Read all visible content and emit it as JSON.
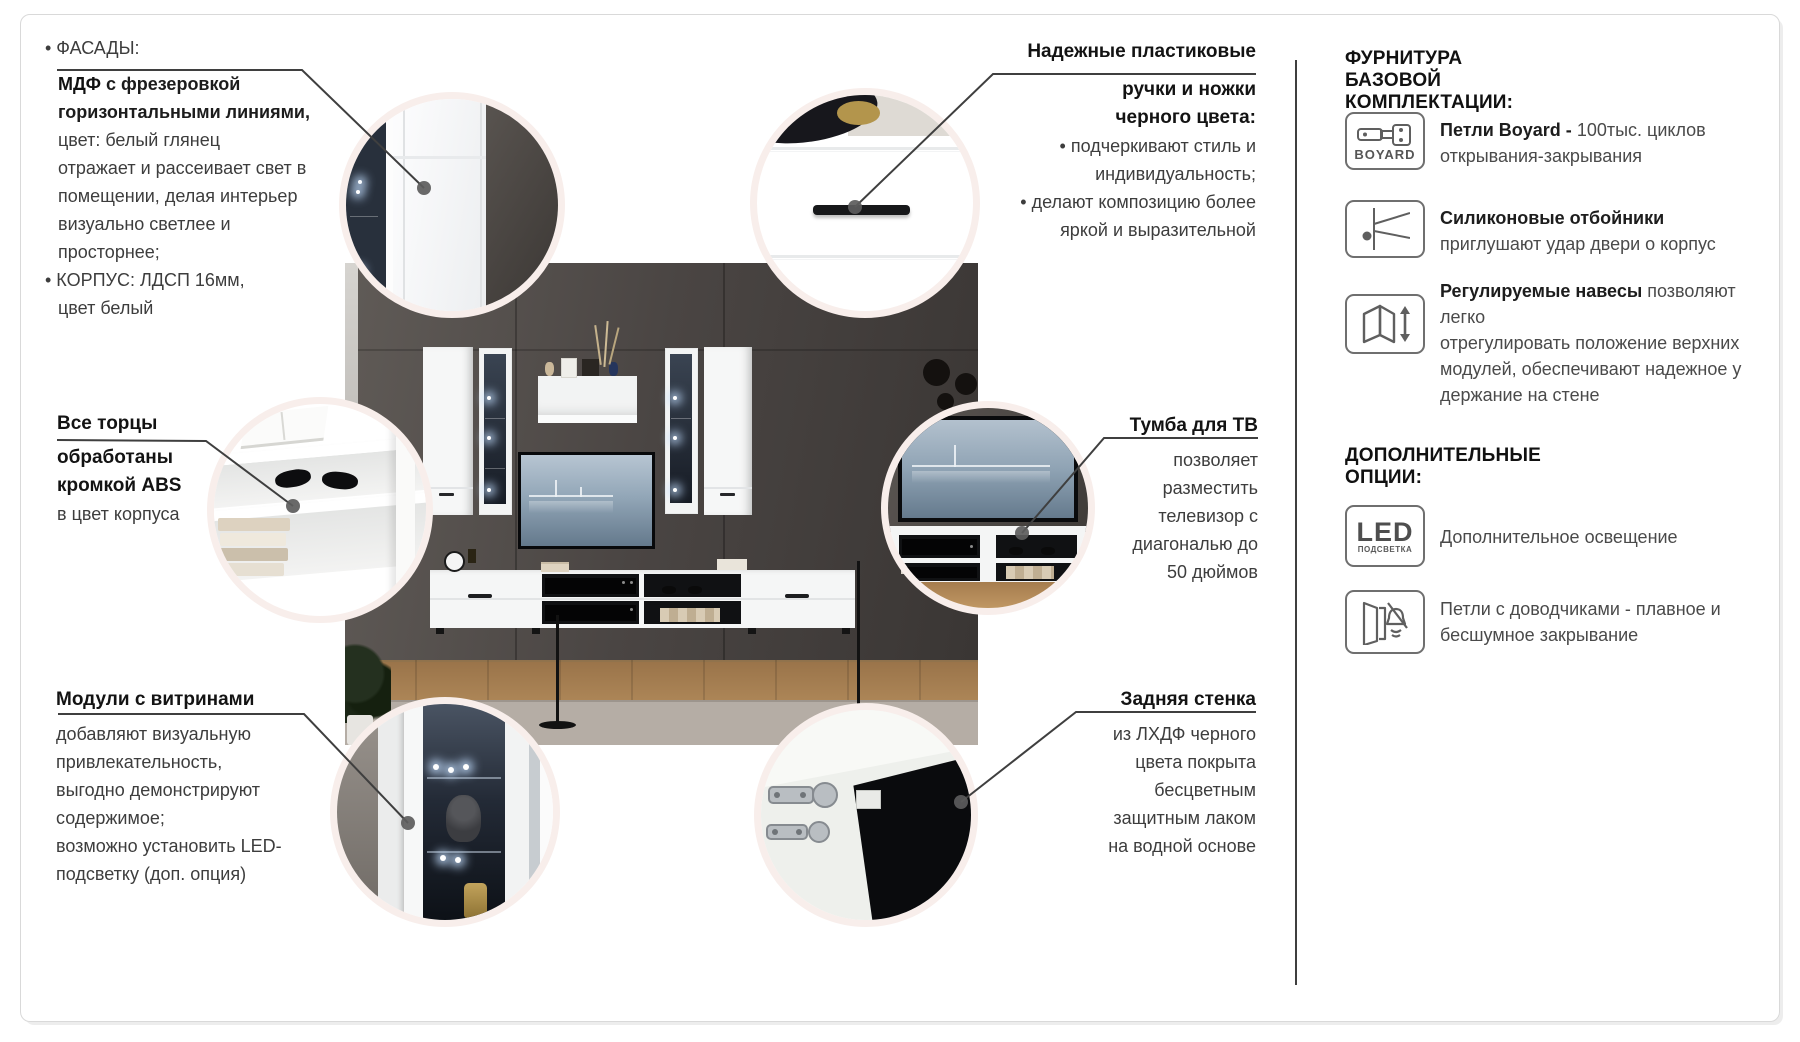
{
  "callouts": {
    "facades": {
      "bullet1": "• ФАСАДЫ:",
      "bold_word": "МДФ",
      "bold_rest": " с фрезеровкой",
      "bold_line2": "горизонтальными линиями,",
      "body": [
        "цвет: белый глянец",
        "отражает и рассеивает свет в",
        "помещении,  делая интерьер",
        "визуально светлее и",
        "просторнее;"
      ],
      "bullet2": "• КОРПУС: ЛДСП 16мм,",
      "bullet2_line2": "цвет белый"
    },
    "handles": {
      "title_lines": [
        "Надежные пластиковые",
        "ручки и ножки",
        "черного цвета:"
      ],
      "body_lines": [
        "• подчеркивают стиль и",
        "индивидуальность;",
        "• делают композицию более",
        "яркой и выразительной"
      ]
    },
    "abs_edges": {
      "title_lines": [
        "Все торцы",
        "обработаны",
        "кромкой ABS"
      ],
      "body_lines": [
        "в цвет корпуса"
      ]
    },
    "tv_unit": {
      "title": "Тумба для ТВ",
      "body_lines": [
        "позволяет",
        "разместить",
        "телевизор с",
        "диагональю до",
        "50 дюймов"
      ]
    },
    "vitrines": {
      "title": "Модули с витринами",
      "body_lines": [
        "добавляют визуальную",
        "привлекательность,",
        "выгодно демонстрируют",
        "содержимое;",
        "возможно установить LED-",
        "подсветку (доп. опция)"
      ]
    },
    "back_panel": {
      "title": "Задняя стенка",
      "body_lines": [
        "из ЛХДФ черного",
        "цвета покрыта",
        "бесцветным",
        "защитным лаком",
        "на водной основе"
      ]
    }
  },
  "sidebar": {
    "section1_title": "ФУРНИТУРА БАЗОВОЙ КОМПЛЕКТАЦИИ:",
    "boyard": {
      "icon": "boyard-hinge-icon",
      "badge": "BOYARD",
      "bold": "Петли Boyard - ",
      "rest": "100тыс. циклов",
      "line2": "открывания-закрывания"
    },
    "bumpers": {
      "icon": "silicone-bumper-icon",
      "bold": "Силиконовые отбойники",
      "line2": "приглушают удар двери о корпус"
    },
    "hangers": {
      "icon": "adjustable-hanger-icon",
      "bold": "Регулируемые навесы",
      "rest": " позволяют легко",
      "lines": [
        "отрегулировать положение верхних",
        "модулей, обеспечивают надежное у",
        "держание на стене"
      ]
    },
    "section2_title": "ДОПОЛНИТЕЛЬНЫЕ ОПЦИИ:",
    "led": {
      "icon": "led-light-icon",
      "badge_main": "LED",
      "badge_sub": "ПОДСВЕТКА",
      "text": "Дополнительное освещение"
    },
    "softclose": {
      "icon": "soft-close-hinge-icon",
      "lines": [
        "Петли с доводчиками - плавное и",
        "бесшумное закрывание"
      ]
    }
  },
  "colors": {
    "ring": "#f8eeeb",
    "leader_line": "#3f3f3f",
    "divider": "#3f3f3f",
    "text_dark": "#131313",
    "text_body": "#3d3d3d",
    "icon_stroke": "#5f5f5f",
    "page_border": "#d9d9d9"
  }
}
